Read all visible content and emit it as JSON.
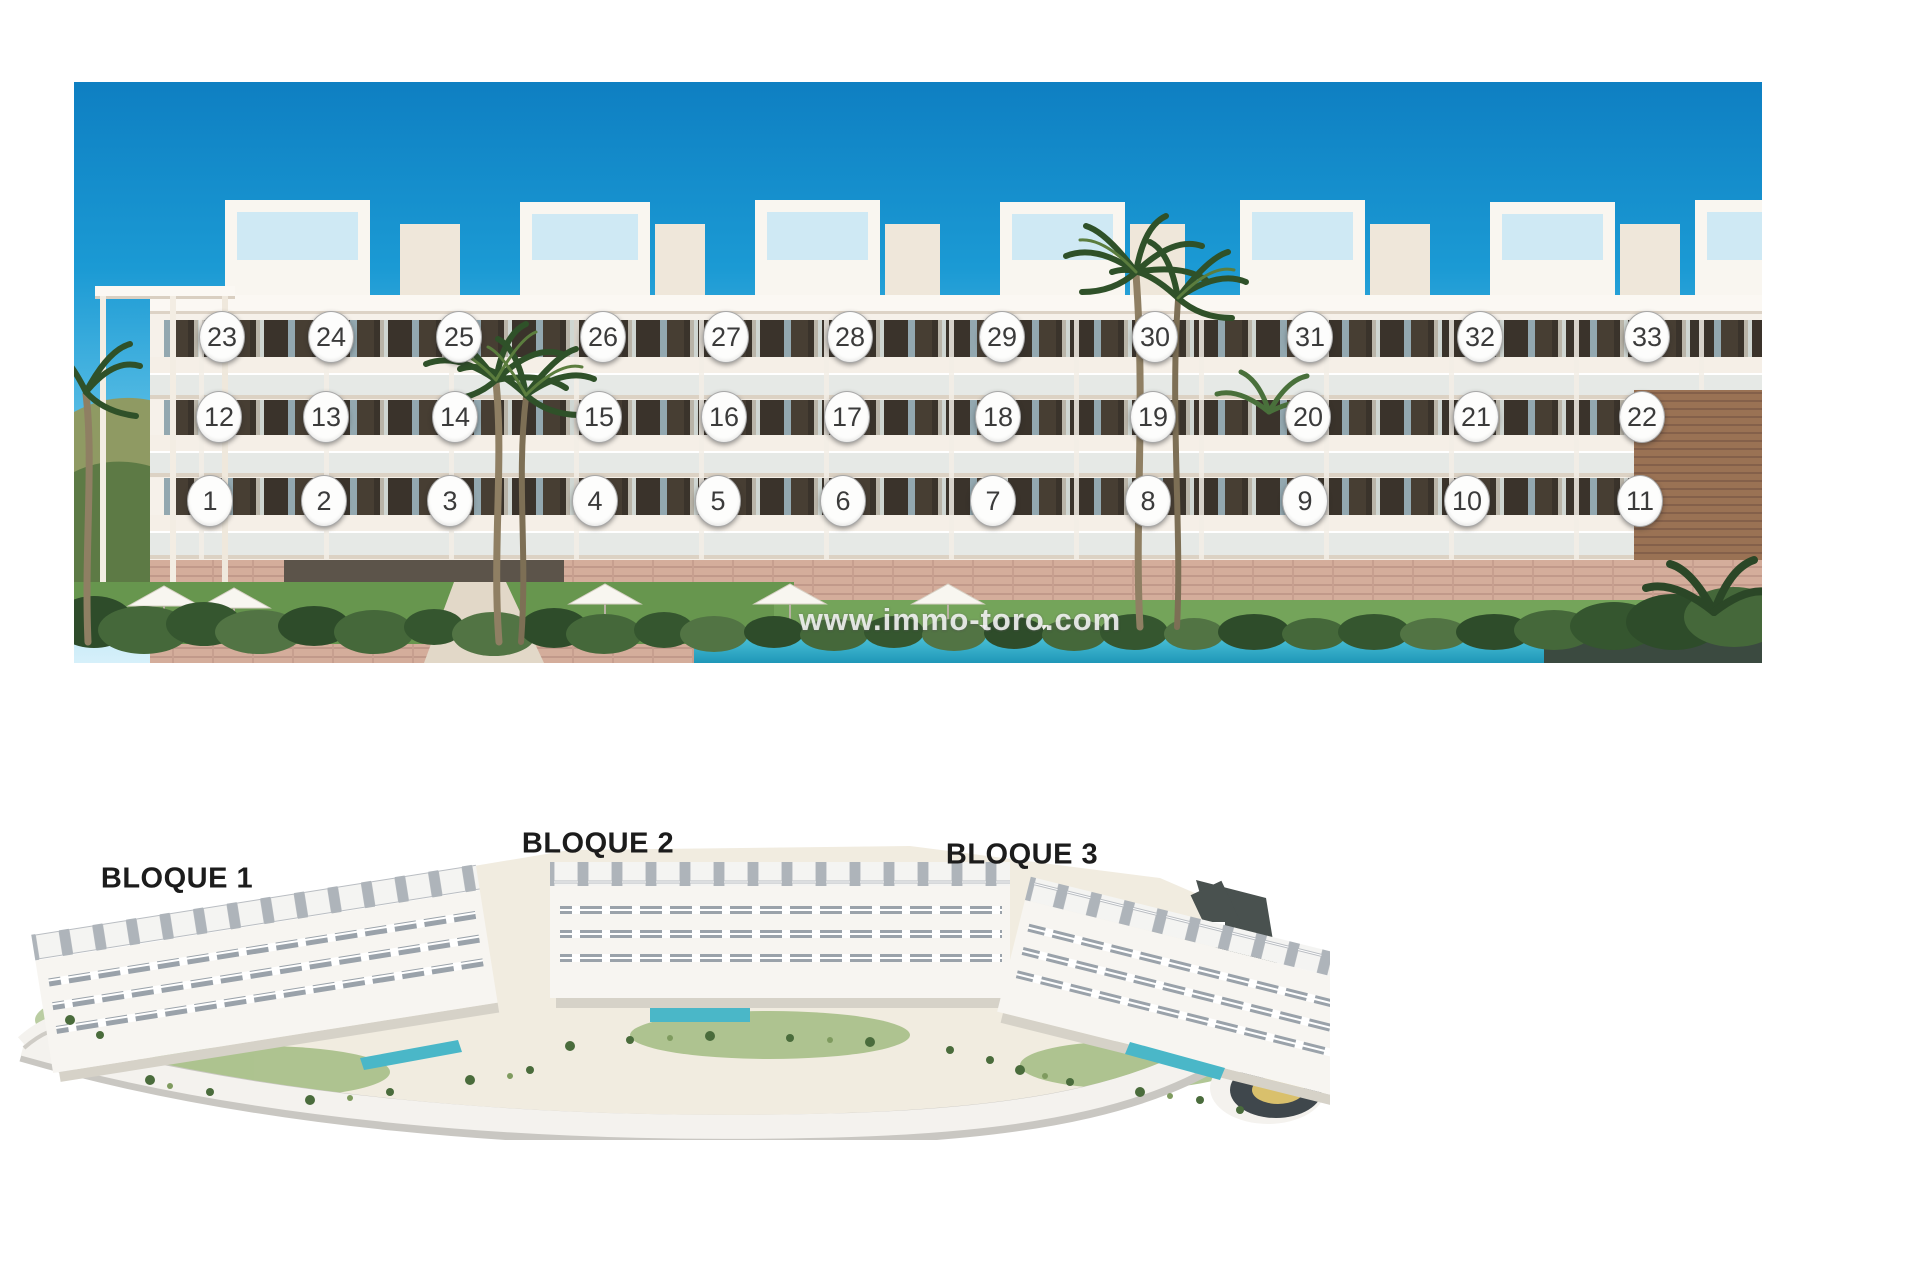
{
  "photo": {
    "watermark": {
      "text": "www.immo-toro.com",
      "cx": 886,
      "cy": 538
    },
    "unit_rows": [
      {
        "floor": "top",
        "cy": 255,
        "units": [
          {
            "n": "23",
            "cx": 148
          },
          {
            "n": "24",
            "cx": 257
          },
          {
            "n": "25",
            "cx": 385
          },
          {
            "n": "26",
            "cx": 529
          },
          {
            "n": "27",
            "cx": 652
          },
          {
            "n": "28",
            "cx": 776
          },
          {
            "n": "29",
            "cx": 928
          },
          {
            "n": "30",
            "cx": 1081
          },
          {
            "n": "31",
            "cx": 1236
          },
          {
            "n": "32",
            "cx": 1406
          },
          {
            "n": "33",
            "cx": 1573
          }
        ]
      },
      {
        "floor": "middle",
        "cy": 335,
        "units": [
          {
            "n": "12",
            "cx": 145
          },
          {
            "n": "13",
            "cx": 252
          },
          {
            "n": "14",
            "cx": 381
          },
          {
            "n": "15",
            "cx": 525
          },
          {
            "n": "16",
            "cx": 650
          },
          {
            "n": "17",
            "cx": 773
          },
          {
            "n": "18",
            "cx": 924
          },
          {
            "n": "19",
            "cx": 1079
          },
          {
            "n": "20",
            "cx": 1234
          },
          {
            "n": "21",
            "cx": 1402
          },
          {
            "n": "22",
            "cx": 1568
          }
        ]
      },
      {
        "floor": "ground",
        "cy": 419,
        "units": [
          {
            "n": "1",
            "cx": 136
          },
          {
            "n": "2",
            "cx": 250
          },
          {
            "n": "3",
            "cx": 376
          },
          {
            "n": "4",
            "cx": 521
          },
          {
            "n": "5",
            "cx": 644
          },
          {
            "n": "6",
            "cx": 769
          },
          {
            "n": "7",
            "cx": 919
          },
          {
            "n": "8",
            "cx": 1074
          },
          {
            "n": "9",
            "cx": 1231
          },
          {
            "n": "10",
            "cx": 1393
          },
          {
            "n": "11",
            "cx": 1566
          }
        ]
      }
    ]
  },
  "site_plan": {
    "labels": [
      {
        "text": "BLOQUE 1",
        "cx": 177,
        "cy": 879
      },
      {
        "text": "BLOQUE 2",
        "cx": 598,
        "cy": 844
      },
      {
        "text": "BLOQUE 3",
        "cx": 1022,
        "cy": 855
      }
    ]
  },
  "colors": {
    "sky_top": "#0e7fc2",
    "sky_horizon": "#d6f0fa",
    "facade": "#f6f1ea",
    "window_glass": "#3a332b",
    "stone_base": "#d4ad9b",
    "grass": "#67964e",
    "pool": "#3db4cf",
    "dark_band": "#3b4a40",
    "road_dark": "#49514f",
    "roundabout_center": "#d9c06c",
    "marker_bg": "#fdfdfc",
    "marker_text": "#3b3b3b"
  }
}
